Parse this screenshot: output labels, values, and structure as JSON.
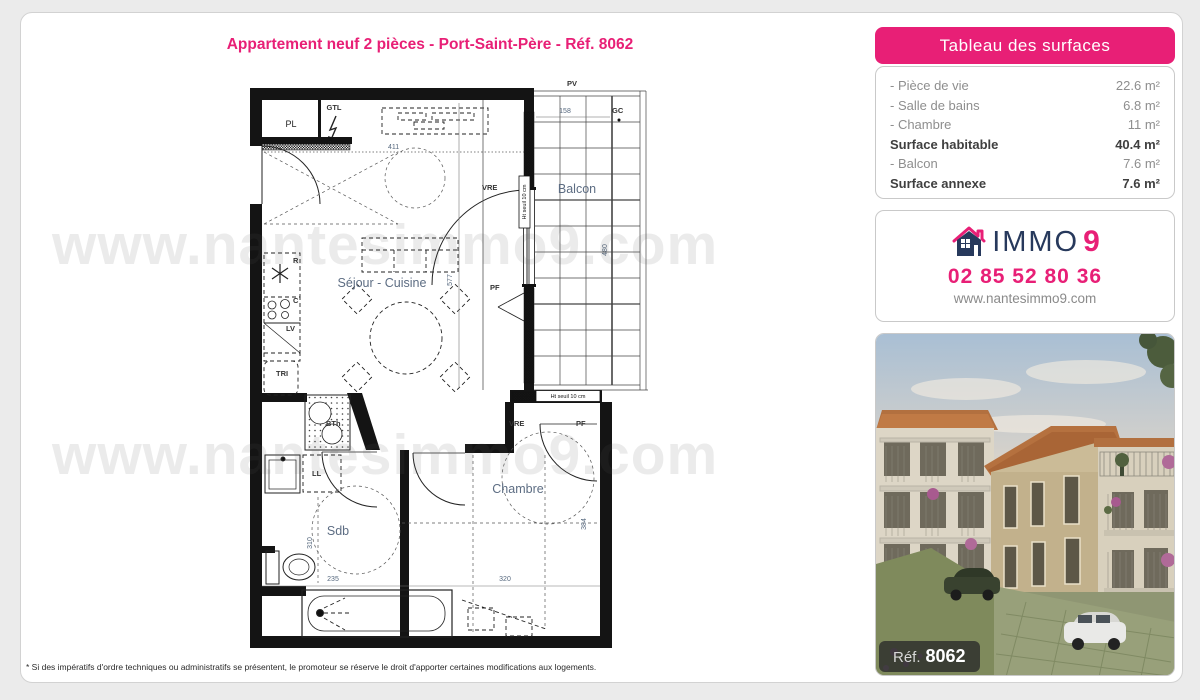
{
  "page": {
    "title": "Appartement neuf 2 pièces - Port-Saint-Père - Réf. 8062",
    "footnote": "* Si des impératifs d'ordre techniques ou administratifs se présentent, le promoteur se réserve le droit d'apporter certaines modifications aux logements."
  },
  "watermark": {
    "text": "www.nantesimmo9.com"
  },
  "surfaces": {
    "header": "Tableau des surfaces",
    "rows": [
      {
        "label": "- Pièce de vie",
        "value": "22.6 m²"
      },
      {
        "label": "- Salle de bains",
        "value": "6.8 m²"
      },
      {
        "label": "- Chambre",
        "value": "11 m²"
      },
      {
        "label": "Surface habitable",
        "value": "40.4 m²"
      },
      {
        "label": "- Balcon",
        "value": "7.6 m²"
      },
      {
        "label": "Surface annexe",
        "value": "7.6 m²"
      }
    ]
  },
  "contact": {
    "brand_main": "IMMO",
    "brand_nine": "9",
    "phone": "02 85 52 80 36",
    "website": "www.nantesimmo9.com",
    "logo_icon": "house-icon"
  },
  "photo": {
    "ref_label": "Réf.",
    "ref_number": "8062"
  },
  "plan": {
    "rooms": {
      "sejour": "Séjour - Cuisine",
      "chambre": "Chambre",
      "sdb": "Sdb",
      "balcon": "Balcon"
    },
    "fixtures": {
      "pl": "PL",
      "gtl": "GTL",
      "r": "R",
      "c": "C",
      "lv": "LV",
      "tri": "TRI",
      "bth": "BTh",
      "ll": "LL"
    },
    "openings": {
      "vre": "VRE",
      "pf": "PF",
      "pv": "PV",
      "gc": "GC",
      "seuil": "Ht seuil 10 cm"
    },
    "dims": {
      "d411": "411",
      "d577": "577",
      "d158": "158",
      "d480": "480",
      "d310": "310",
      "d235": "235",
      "d320": "320",
      "d384": "384"
    }
  },
  "colors": {
    "accent": "#e81f76",
    "navy": "#27395c"
  }
}
